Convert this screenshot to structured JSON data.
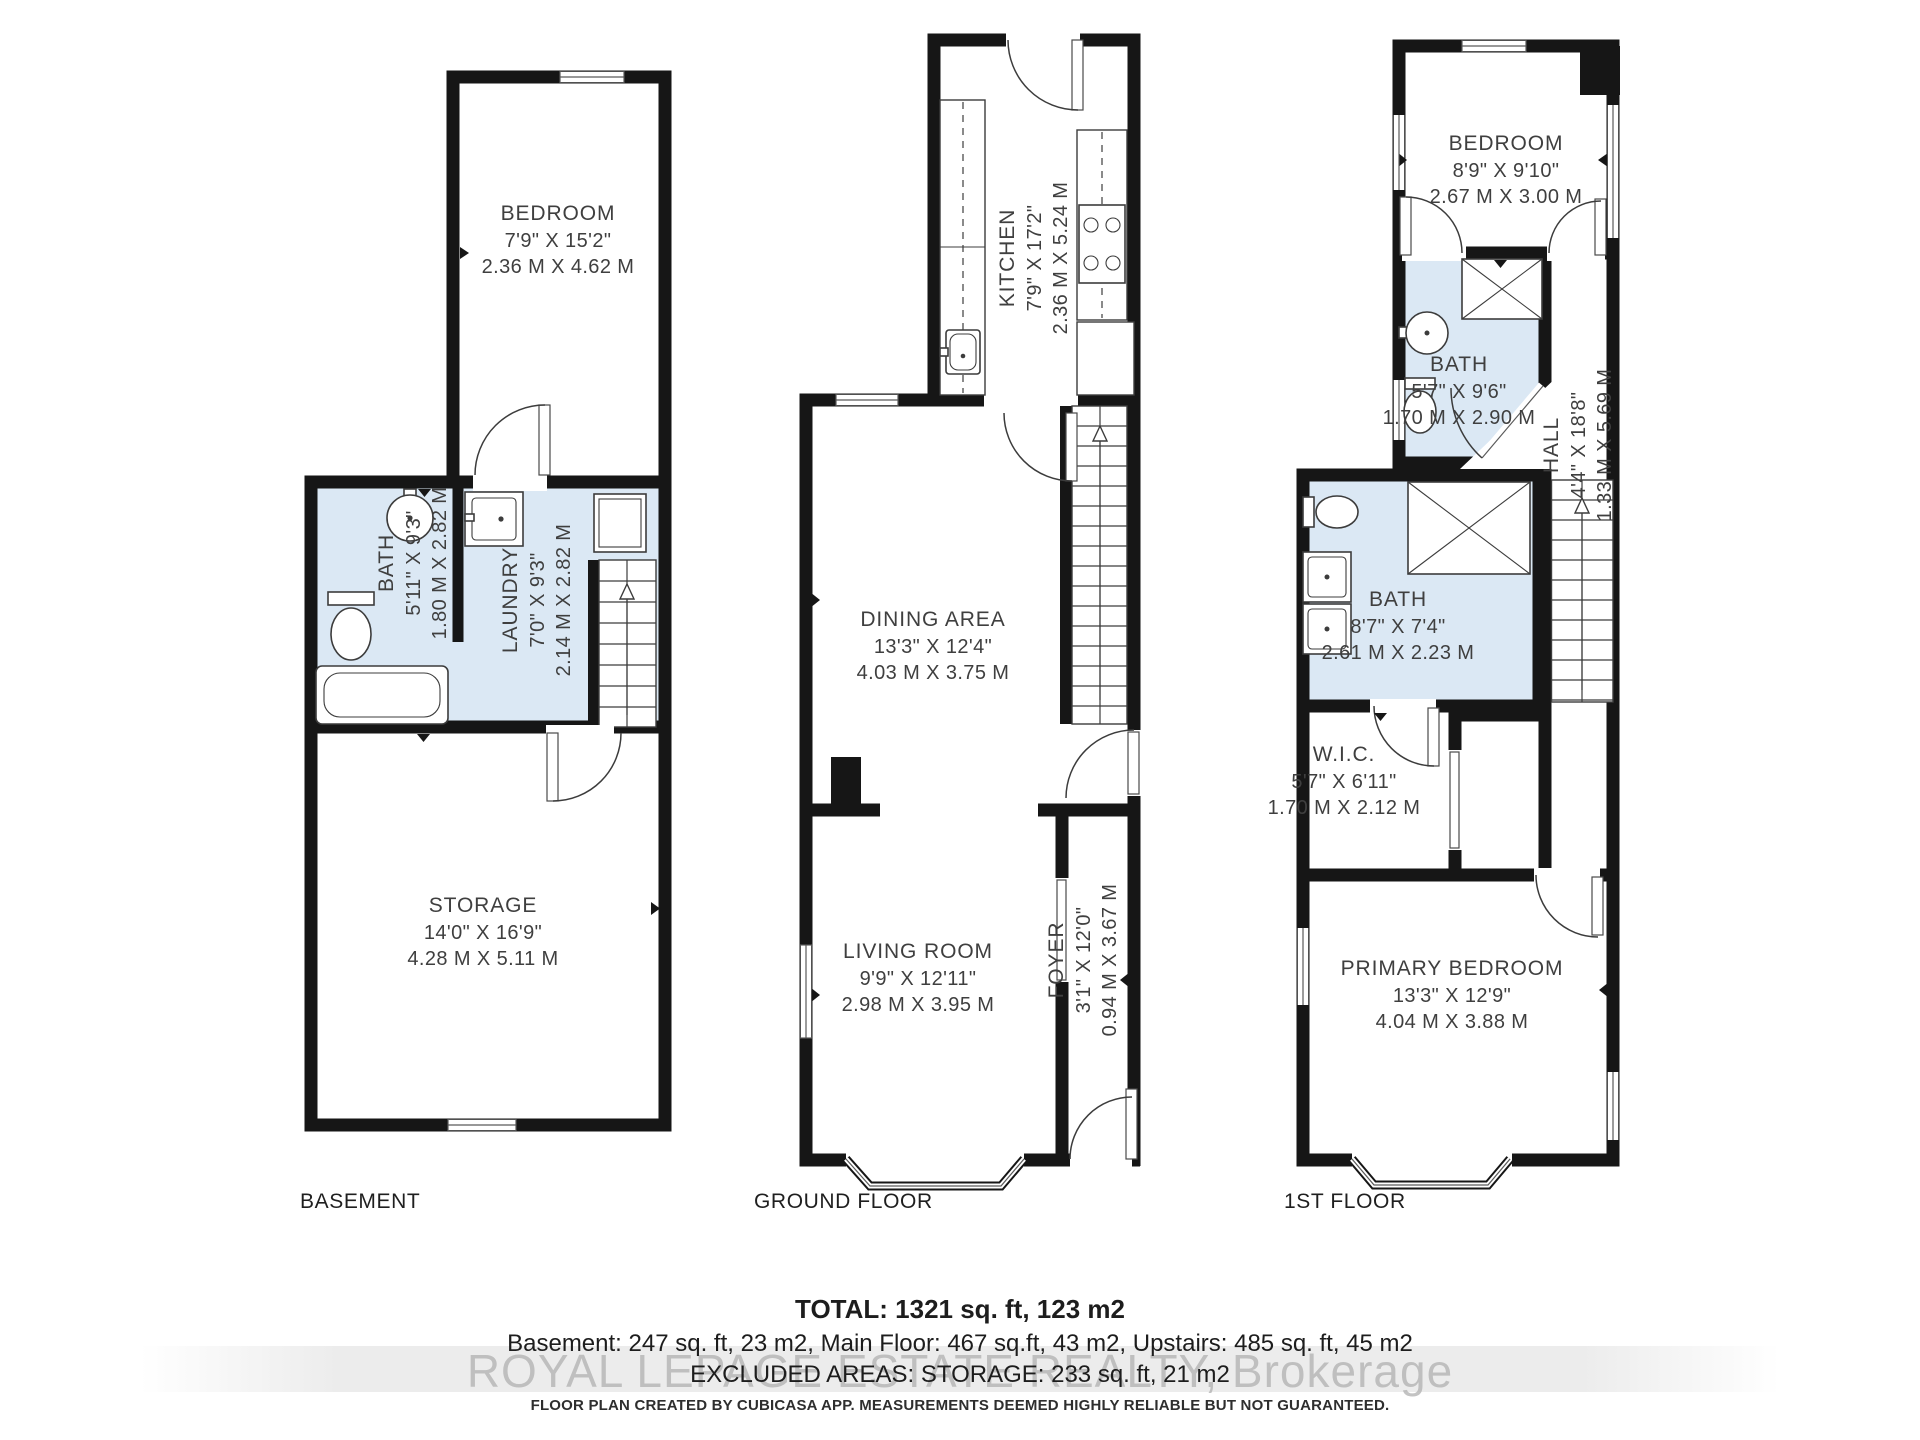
{
  "colors": {
    "wall": "#161616",
    "bath_fill": "#dbe8f4",
    "label_text": "#3f3f3f",
    "watermark_text": "#b5b5b5"
  },
  "basement": {
    "floor_label": "BASEMENT",
    "bedroom": {
      "name": "BEDROOM",
      "dim_ft": "7'9\" X 15'2\"",
      "dim_m": "2.36 M X 4.62 M"
    },
    "bath": {
      "name": "BATH",
      "dim_ft": "5'11\" X 9'3\"",
      "dim_m": "1.80 M X 2.82 M"
    },
    "laundry": {
      "name": "LAUNDRY",
      "dim_ft": "7'0\" X 9'3\"",
      "dim_m": "2.14 M X 2.82 M"
    },
    "storage": {
      "name": "STORAGE",
      "dim_ft": "14'0\" X 16'9\"",
      "dim_m": "4.28 M X 5.11 M"
    }
  },
  "ground": {
    "floor_label": "GROUND FLOOR",
    "kitchen": {
      "name": "KITCHEN",
      "dim_ft": "7'9\" X 17'2\"",
      "dim_m": "2.36 M X 5.24 M"
    },
    "dining": {
      "name": "DINING AREA",
      "dim_ft": "13'3\" X 12'4\"",
      "dim_m": "4.03 M X 3.75 M"
    },
    "living": {
      "name": "LIVING ROOM",
      "dim_ft": "9'9\" X 12'11\"",
      "dim_m": "2.98 M X 3.95 M"
    },
    "foyer": {
      "name": "FOYER",
      "dim_ft": "3'1\" X 12'0\"",
      "dim_m": "0.94 M X 3.67 M"
    }
  },
  "first": {
    "floor_label": "1ST FLOOR",
    "bedroom": {
      "name": "BEDROOM",
      "dim_ft": "8'9\" X 9'10\"",
      "dim_m": "2.67 M X 3.00 M"
    },
    "bath_upper": {
      "name": "BATH",
      "dim_ft": "5'7\" X 9'6\"",
      "dim_m": "1.70 M X 2.90 M"
    },
    "hall": {
      "name": "HALL",
      "dim_ft": "4'4\" X 18'8\"",
      "dim_m": "1.33 M X 5.69 M"
    },
    "bath_main": {
      "name": "BATH",
      "dim_ft": "8'7\" X 7'4\"",
      "dim_m": "2.61 M X 2.23 M"
    },
    "wic": {
      "name": "W.I.C.",
      "dim_ft": "5'7\" X 6'11\"",
      "dim_m": "1.70 M X 2.12 M"
    },
    "primary": {
      "name": "PRIMARY BEDROOM",
      "dim_ft": "13'3\" X 12'9\"",
      "dim_m": "4.04 M X 3.88 M"
    }
  },
  "footer": {
    "total": "TOTAL: 1321 sq. ft, 123 m2",
    "breakdown": "Basement: 247 sq. ft, 23 m2, Main Floor: 467 sq.ft, 43 m2, Upstairs: 485 sq. ft, 45 m2",
    "excluded": "EXCLUDED AREAS: STORAGE: 233 sq. ft, 21 m2",
    "watermark": "ROYAL LEPAGE ESTATE REALTY, Brokerage",
    "disclaimer": "FLOOR PLAN CREATED BY CUBICASA APP. MEASUREMENTS DEEMED HIGHLY RELIABLE BUT NOT GUARANTEED."
  }
}
